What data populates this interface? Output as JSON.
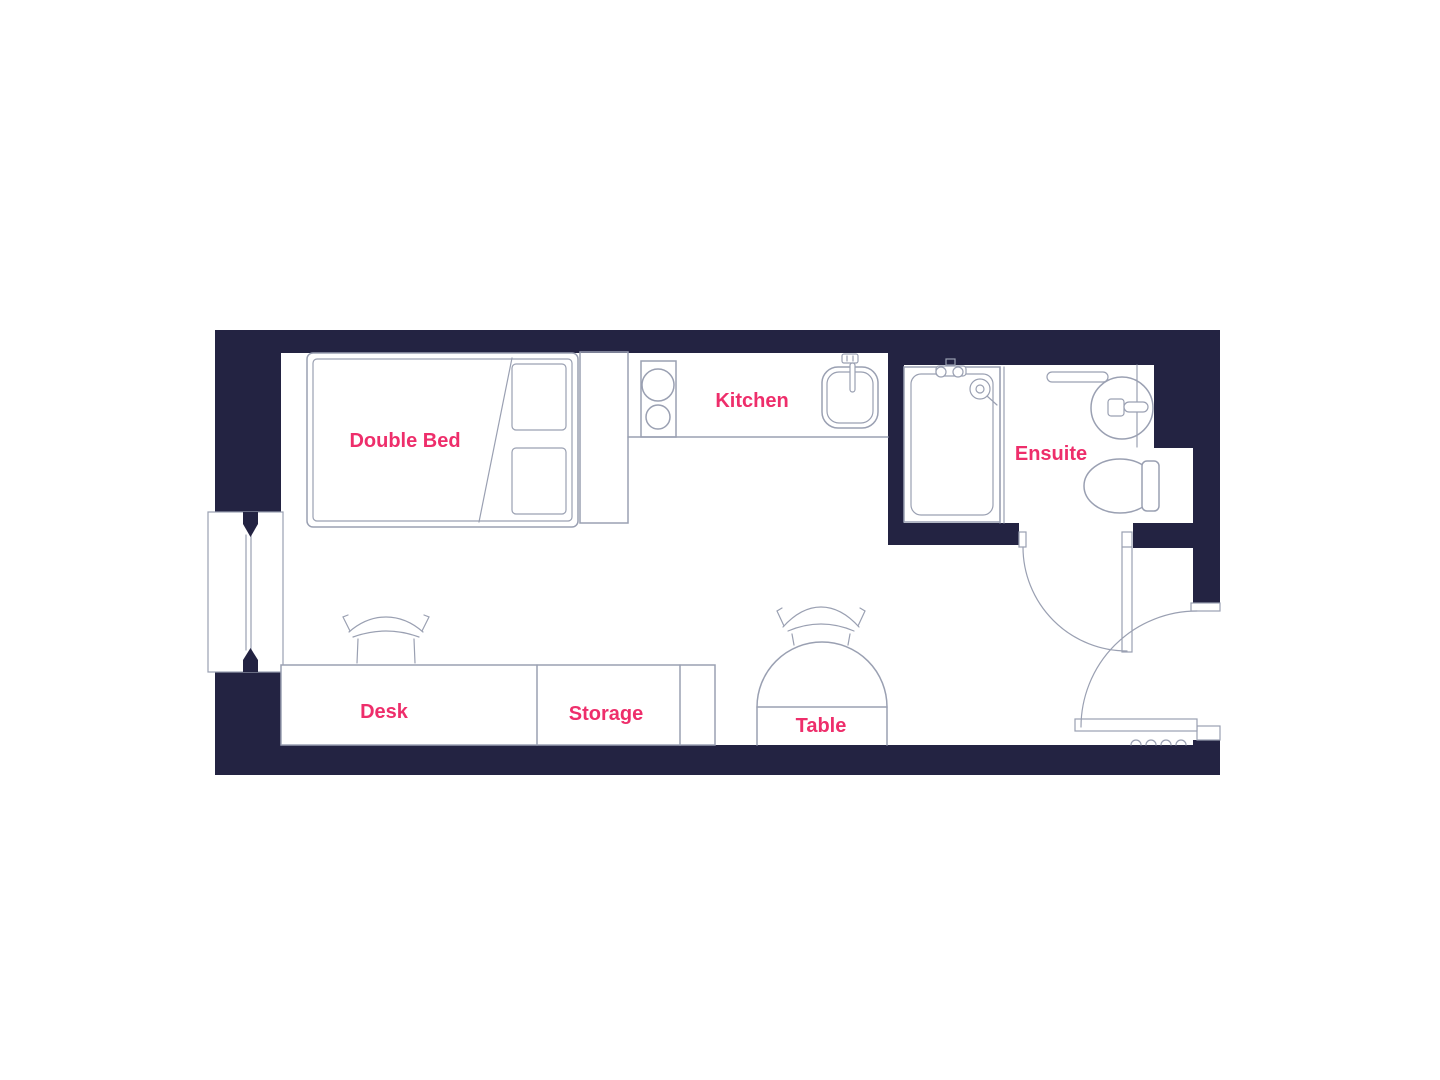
{
  "plan": {
    "type": "studio-apartment-floorplan",
    "labels": {
      "double_bed": "Double Bed",
      "kitchen": "Kitchen",
      "ensuite": "Ensuite",
      "desk": "Desk",
      "storage": "Storage",
      "table": "Table"
    },
    "colors": {
      "wall": "#232342",
      "line": "#9aa0b2",
      "label": "#ee2e6b",
      "background": "#ffffff"
    },
    "fixtures": [
      "double-bed",
      "pillows",
      "headboard",
      "kitchen-hob",
      "kitchen-sink",
      "kitchen-counter",
      "shower",
      "shower-head",
      "shower-partition",
      "bathroom-shelf",
      "wash-basin",
      "toilet",
      "wall-recess",
      "ensuite-door",
      "entrance-door",
      "window",
      "desk-counter",
      "storage-unit",
      "desk-chair",
      "table-chair",
      "half-round-table",
      "threshold-strip"
    ]
  }
}
